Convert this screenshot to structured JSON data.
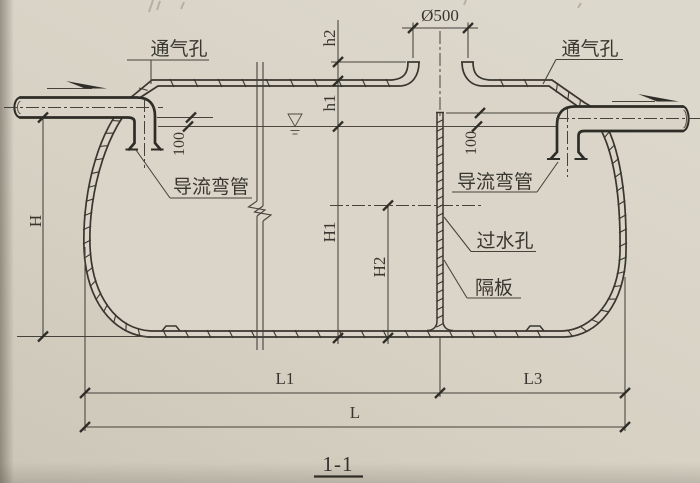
{
  "drawing": {
    "section_label": "1-1",
    "labels": {
      "vent_left": "通气孔",
      "vent_right": "通气孔",
      "manhole_diameter": "Ø500",
      "guide_elbow_left": "导流弯管",
      "guide_elbow_right": "导流弯管",
      "water_hole": "过水孔",
      "partition": "隔板"
    },
    "dimensions": {
      "h2": "h2",
      "h1": "h1",
      "inlet_drop": "100",
      "partition_top_drop": "100",
      "H": "H",
      "H1": "H1",
      "H2": "H2",
      "L1": "L1",
      "L3": "L3",
      "L": "L"
    },
    "colors": {
      "paper": "#d6d0c3",
      "ink": "#38362f"
    }
  }
}
